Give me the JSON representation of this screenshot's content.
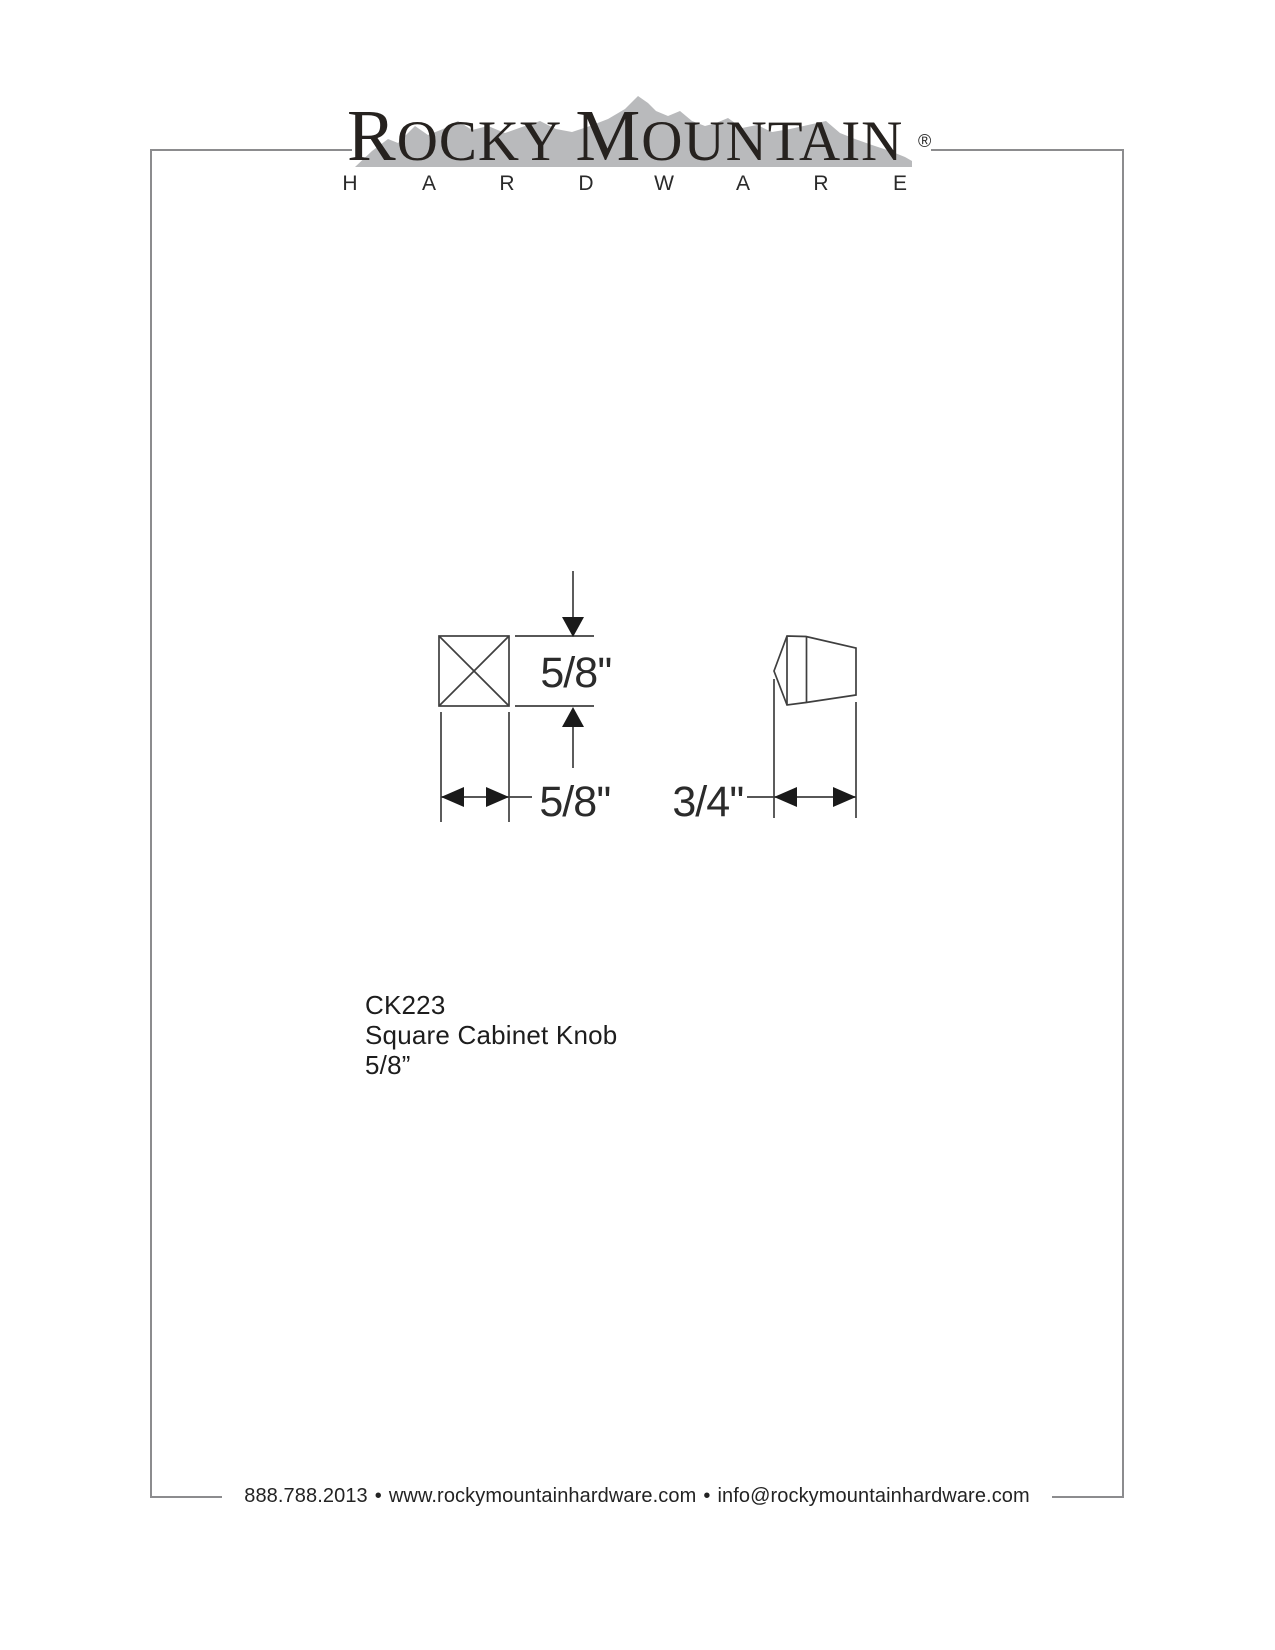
{
  "page": {
    "background_color": "#ffffff",
    "frame_color": "#8c8c8e"
  },
  "brand": {
    "wordmark": {
      "initial_1": "R",
      "part_1": "OCKY ",
      "initial_2": "M",
      "part_2": "OUNTAIN"
    },
    "registered_mark": "®",
    "subtitle_letters": [
      "H",
      "A",
      "R",
      "D",
      "W",
      "A",
      "R",
      "E"
    ],
    "text_color": "#26221f",
    "mountain_color": "#b9babc"
  },
  "drawing": {
    "line_color": "#3f3f3f",
    "arrow_color": "#1a1a1a",
    "front_view": {
      "height_label": "5/8''",
      "width_label": "5/8''"
    },
    "side_view": {
      "projection_label": "3/4''"
    }
  },
  "product": {
    "sku": "CK223",
    "name": "Square Cabinet Knob",
    "size": "5/8”"
  },
  "footer": {
    "phone": "888.788.2013",
    "separator": "•",
    "website": "www.rockymountainhardware.com",
    "email": "info@rockymountainhardware.com"
  }
}
